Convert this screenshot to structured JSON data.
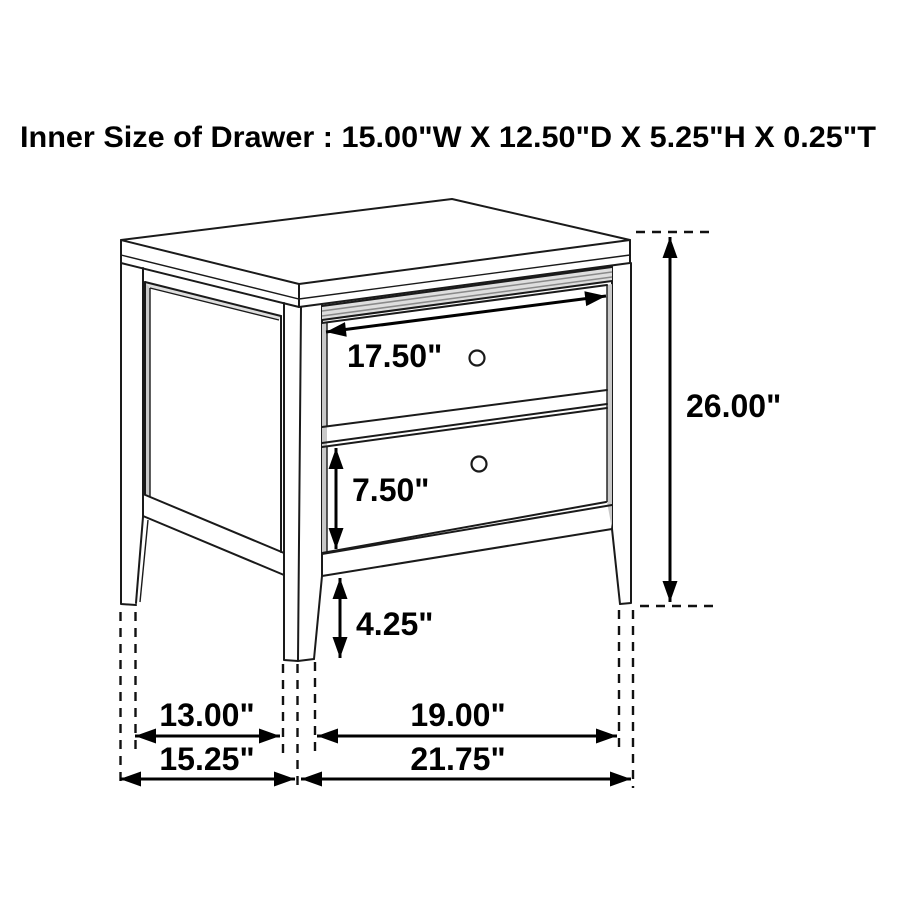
{
  "title": {
    "text": "Inner Size of Drawer : 15.00\"W X 12.50\"D X 5.25\"H X 0.25\"T"
  },
  "diagram": {
    "type": "furniture-dimension-diagram",
    "item": "two-drawer nightstand line drawing",
    "labels": {
      "drawer_face_width": "17.50\"",
      "bottom_drawer_face_height": "7.50\"",
      "overall_height": "26.00\"",
      "leg_height": "4.25\"",
      "side_inner_span": "13.00\"",
      "side_overall_depth": "15.25\"",
      "front_inner_span": "19.00\"",
      "front_overall_width": "21.75\""
    }
  },
  "colors": {
    "background": "#ffffff",
    "line": "#1a1a1a",
    "text": "#000000",
    "shadow_grey": "#c9c9c9",
    "molding_grey": "#dedede"
  }
}
